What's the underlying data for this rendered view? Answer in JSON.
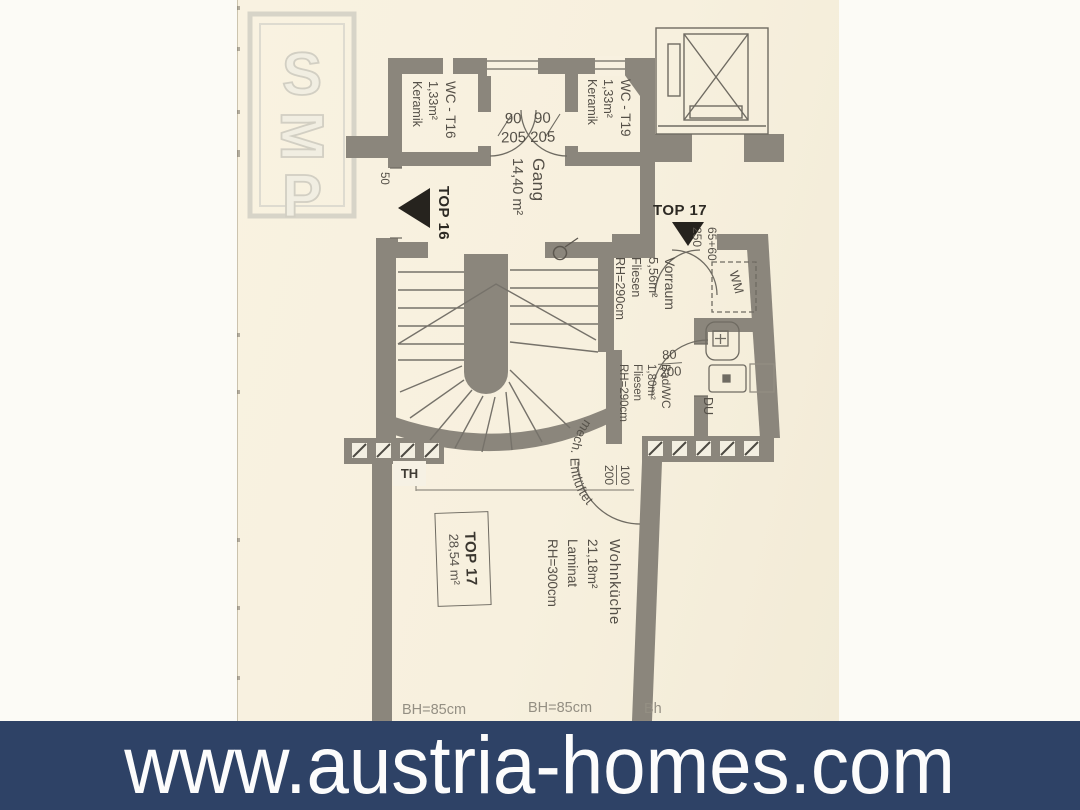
{
  "banner": {
    "url": "www.austria-homes.com"
  },
  "watermark": {
    "l1": "S",
    "l2": "M",
    "l3": "P"
  },
  "rooms": {
    "wc16": {
      "name": "WC - T16",
      "area": "1,33m²",
      "floor": "Keramik"
    },
    "wc19": {
      "name": "WC - T19",
      "area": "1,33m²",
      "floor": "Keramik"
    },
    "gang": {
      "name": "Gang",
      "area": "14,40 m²"
    },
    "vorraum": {
      "name": "Vorraum",
      "area": "5,56m²",
      "floor": "Fliesen",
      "rh": "RH=290cm"
    },
    "bad": {
      "name": "Bad/WC",
      "area": "1,80m²",
      "floor": "Fliesen",
      "rh": "RH=290cm",
      "vent": "mech. Entlüftet"
    },
    "wohnkueche": {
      "name": "Wohnküche",
      "area": "21,18m²",
      "floor": "Laminat",
      "rh": "RH=300cm"
    },
    "unit17": {
      "name": "TOP 17",
      "area": "28,54 m²"
    }
  },
  "doors": {
    "top16_label": "TOP 16",
    "top16_dim": "50",
    "top17_label": "TOP 17",
    "top17_w": "65+60",
    "top17_h": "250",
    "wc_w": "90   90",
    "wc_h": "205 205",
    "bad_w": "80",
    "bad_h": "200",
    "wk_w": "100",
    "wk_h": "200"
  },
  "fixtures": {
    "wm": "WM",
    "du": "DU",
    "th": "TH"
  },
  "sills": {
    "b1": "BH=85cm",
    "b2": "BH=85cm",
    "b3": "Bh"
  }
}
